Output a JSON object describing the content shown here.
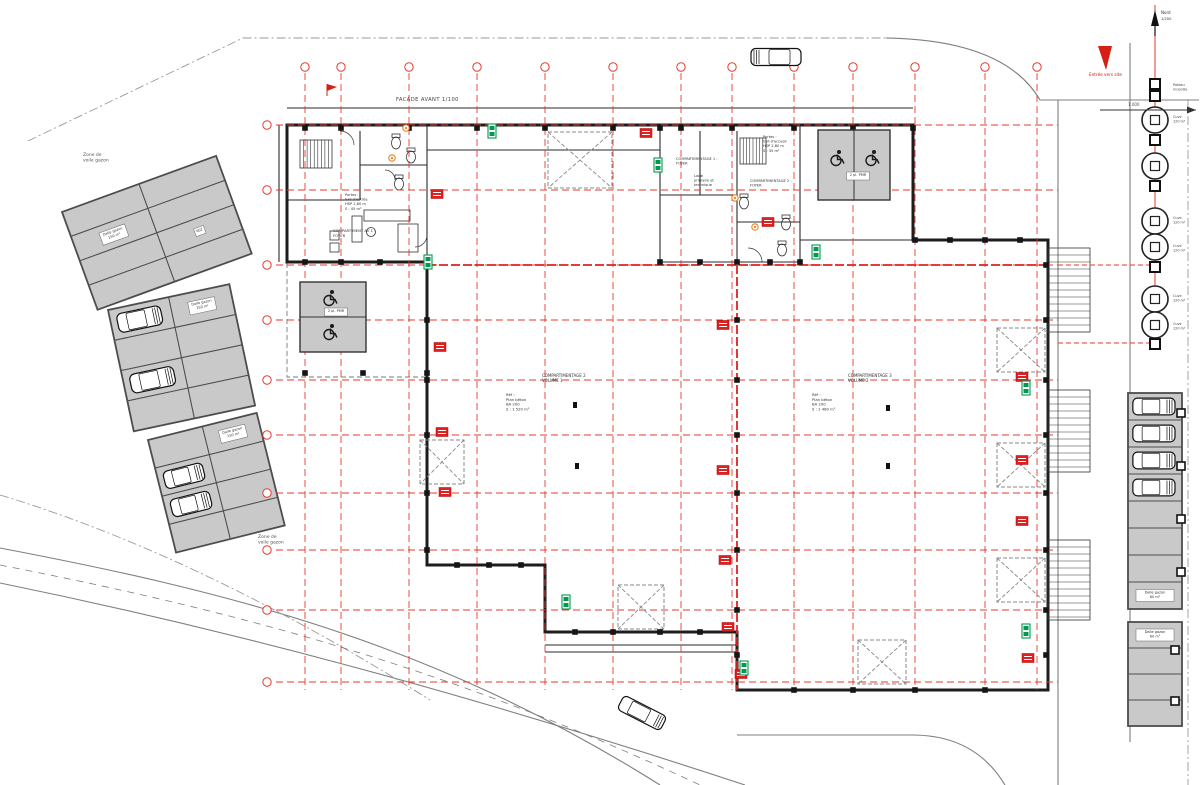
{
  "colors": {
    "grid_red": "#e63a2e",
    "compartment_red": "#e02020",
    "wall": "#1d1d1d",
    "inner_wall": "#2a2a2a",
    "parking_fill": "#c9c9c9",
    "parking_border": "#4d4d4d",
    "road": "#7f7f7f",
    "boundary": "#9a9a9a",
    "exit_green": "#00994d",
    "fire_red": "#e02020",
    "door_orange": "#f5821f",
    "text_gray": "#444444",
    "arrow_red": "#d42015"
  },
  "labels": {
    "facade": "FACADE AVANT 1/100",
    "entrance": "Entrée vers site",
    "north": "Nord",
    "room403": "403"
  },
  "texts": [
    {
      "x": 83,
      "y": 156,
      "size": 4.5,
      "color": "#555555",
      "lines": [
        "Zone de",
        "voile gazon"
      ],
      "name": "zone-label-topleft"
    },
    {
      "x": 258,
      "y": 538,
      "size": 4.5,
      "color": "#555555",
      "lines": [
        "Zone de",
        "voile gazon"
      ],
      "name": "zone-label-bottomleft"
    },
    {
      "x": 542,
      "y": 377,
      "size": 4,
      "color": "#333333",
      "lines": [
        "COMPARTIMENTAGE 2",
        "VOLUME 1"
      ],
      "name": "hall1-title"
    },
    {
      "x": 506,
      "y": 396,
      "size": 3.8,
      "color": "#333333",
      "lines": [
        "Réf :",
        "Plan béton",
        "BA 200",
        "S : 1 520 m²"
      ],
      "name": "hall1-info"
    },
    {
      "x": 848,
      "y": 377,
      "size": 4,
      "color": "#333333",
      "lines": [
        "COMPARTIMENTAGE 3",
        "VOLUME 2"
      ],
      "name": "hall2-title"
    },
    {
      "x": 812,
      "y": 396,
      "size": 3.8,
      "color": "#333333",
      "lines": [
        "Réf :",
        "Plan béton",
        "BA 200",
        "S : 1 480 m²"
      ],
      "name": "hall2-info"
    },
    {
      "x": 333,
      "y": 232,
      "size": 3.8,
      "color": "#333333",
      "lines": [
        "COMPARTIMENT AV 1 :",
        "FOYER"
      ],
      "name": "office1-title"
    },
    {
      "x": 345,
      "y": 196,
      "size": 3.6,
      "color": "#333333",
      "lines": [
        "Portes :",
        "hall d'entrée",
        "HSP 2,80 m",
        "S : 45 m²"
      ],
      "name": "office1-info"
    },
    {
      "x": 763,
      "y": 138,
      "size": 3.6,
      "color": "#333333",
      "lines": [
        "Portes :",
        "hall d'accueil",
        "HSP 2,80 m",
        "S : 35 m²"
      ],
      "name": "office2-info"
    },
    {
      "x": 676,
      "y": 160,
      "size": 3.6,
      "color": "#333333",
      "lines": [
        "COMPARTIMENTAGE 1 :",
        "FOYER"
      ],
      "name": "office2-title"
    },
    {
      "x": 694,
      "y": 177,
      "size": 3.6,
      "color": "#333333",
      "lines": [
        "Local",
        "primaire et",
        "technique"
      ],
      "name": "office2-local"
    },
    {
      "x": 750,
      "y": 182,
      "size": 3.6,
      "color": "#333333",
      "lines": [
        "COMPARTIMENTAGE 2 :",
        "FOYER"
      ],
      "name": "office2-comp"
    },
    {
      "x": 1128,
      "y": 106,
      "size": 4,
      "color": "#555555",
      "lines": [
        "1.000"
      ],
      "name": "dim-label"
    },
    {
      "x": 1161,
      "y": 20,
      "size": 3.6,
      "color": "#333333",
      "lines": [
        "1/200"
      ],
      "name": "north-scale-label"
    }
  ],
  "drawing": {
    "roads": {
      "solid": [
        "M886,38 Q1005,40 1040,100 L1199,100",
        "M1058,100 L1058,785",
        "M1130,43 L1130,742",
        "M0,548 C220,590 430,640 660,785",
        "M0,583 C220,628 450,688 745,785",
        "M737,735 L912,735 Q975,735 1005,785"
      ],
      "dashdot": [
        "M28,141 L243,38 L886,38",
        "M1188,99 L1188,785",
        "M0,495 C150,540 300,618 430,700"
      ],
      "dashed": [
        "M0,565 C220,608 440,663 700,785"
      ]
    },
    "grid": {
      "vx": [
        305,
        341,
        409,
        477,
        545,
        613,
        681,
        732,
        794,
        853,
        915,
        985,
        1037
      ],
      "vy0": 73,
      "vy1": 690,
      "bubble_y": 67,
      "hy": [
        125,
        190,
        265,
        320,
        380,
        435,
        493,
        550,
        610,
        682
      ],
      "hx0": 276,
      "hx1": 1058,
      "bubble_x": 267,
      "extras": [
        [
          1058,
          265,
          1149,
          265
        ],
        [
          1058,
          343,
          1149,
          343
        ]
      ]
    },
    "building": {
      "outline": "M287,125 L913,125 L913,240 L1048,240 L1048,690 L737,690 L737,632 L545,632 L545,565 L427,565 L427,262 L287,262 Z",
      "inner_walls": [
        "M427,125 L427,262",
        "M427,150 L660,150",
        "M360,131 L360,200",
        "M360,165 L427,165",
        "M287,200 L360,200",
        "M660,125 L660,262",
        "M800,125 L800,262",
        "M660,262 L800,262",
        "M660,195 L737,195",
        "M700,131 L700,195",
        "M737,131 L737,262",
        "M737,222 L800,222",
        "M800,240 L913,240",
        "M545,645 L737,645",
        "M545,652 L737,652",
        "M287,108 L913,108",
        "M279,125 L279,262"
      ],
      "stairs": [
        {
          "x": 300,
          "y": 140,
          "w": 32,
          "h": 28,
          "n": 9
        },
        {
          "x": 740,
          "y": 138,
          "w": 26,
          "h": 26,
          "n": 8
        }
      ],
      "toilets": [
        [
          396,
          143
        ],
        [
          411,
          157
        ],
        [
          399,
          184
        ],
        [
          744,
          203
        ],
        [
          786,
          224
        ],
        [
          782,
          250
        ]
      ],
      "desks": [
        [
          352,
          216,
          10,
          26
        ],
        [
          364,
          210,
          46,
          11
        ],
        [
          398,
          224,
          20,
          28
        ],
        [
          330,
          231,
          9,
          9
        ],
        [
          330,
          243,
          9,
          9
        ]
      ],
      "door_arcs": [
        "M340,131 A14,14 0 0 1 354,145",
        "M385,170 A10,10 0 0 1 395,180",
        "M762,262 A14,14 0 0 0 748,248",
        "M427,235 A12,12 0 0 1 415,247"
      ],
      "canopy": {
        "x": 287,
        "y": 262,
        "w": 140,
        "h": 115
      },
      "dock_stairs": [
        [
          248,
          332
        ],
        [
          390,
          472
        ],
        [
          540,
          620
        ]
      ],
      "xboxes": [
        [
          548,
          132,
          64,
          56
        ],
        [
          420,
          440,
          44,
          44
        ],
        [
          618,
          585,
          46,
          44
        ],
        [
          858,
          640,
          48,
          44
        ],
        [
          997,
          328,
          48,
          44
        ],
        [
          997,
          443,
          48,
          44
        ],
        [
          997,
          558,
          48,
          44
        ]
      ],
      "compartment_lines": [
        "M737,265 L737,690",
        "M427,265 L1048,265"
      ],
      "door_symbols": [
        [
          575,
          405
        ],
        [
          577,
          466
        ],
        [
          888,
          408
        ],
        [
          888,
          466
        ]
      ]
    },
    "columns": {
      "rows": [
        {
          "axis": "y",
          "v": 128,
          "pts": [
            305,
            341,
            409,
            477,
            545,
            613,
            660,
            681,
            732,
            794,
            853,
            913
          ]
        },
        {
          "axis": "x",
          "v": 427,
          "pts": [
            265,
            320,
            380,
            435,
            493,
            550
          ]
        },
        {
          "axis": "x",
          "v": 737,
          "pts": [
            320,
            380,
            435,
            493,
            550,
            610,
            655
          ]
        },
        {
          "axis": "x",
          "v": 1046,
          "pts": [
            265,
            320,
            380,
            435,
            493,
            550,
            610,
            655
          ]
        },
        {
          "axis": "y",
          "v": 690,
          "pts": [
            794,
            853,
            915,
            985
          ]
        },
        {
          "axis": "y",
          "v": 632,
          "pts": [
            575,
            613,
            660,
            700
          ]
        },
        {
          "axis": "y",
          "v": 565,
          "pts": [
            457,
            489,
            521
          ]
        },
        {
          "axis": "y",
          "v": 262,
          "pts": [
            305,
            341,
            380,
            427,
            660,
            700,
            737,
            770,
            800
          ]
        },
        {
          "axis": "y",
          "v": 240,
          "pts": [
            915,
            950,
            985,
            1020
          ]
        },
        {
          "axis": "y",
          "v": 373,
          "pts": [
            305,
            363,
            427
          ]
        }
      ]
    },
    "parking": {
      "blocks": [
        {
          "x": 62,
          "y": 212,
          "rot": -20,
          "cols": 2,
          "rows": 4,
          "cw": 82,
          "rh": 26,
          "cars": [],
          "chips": [
            {
              "c": 0,
              "r": 1,
              "lines": [
                "Dalle gazon",
                "150 m²"
              ]
            },
            {
              "c": 1,
              "r": 2,
              "lines": [
                "602"
              ]
            }
          ]
        },
        {
          "x": 108,
          "y": 310,
          "rot": -12,
          "cols": 2,
          "rows": 4,
          "cw": 62,
          "rh": 31,
          "cars": [
            {
              "c": 0,
              "r": 0
            },
            {
              "c": 0,
              "r": 2
            }
          ],
          "chips": [
            {
              "c": 1,
              "r": 0,
              "lines": [
                "Dalle gazon",
                "150 m²"
              ]
            }
          ]
        },
        {
          "x": 148,
          "y": 440,
          "rot": -14,
          "cols": 2,
          "rows": 4,
          "cw": 56,
          "rh": 29,
          "cars": [
            {
              "c": 0,
              "r": 1
            },
            {
              "c": 0,
              "r": 2
            }
          ],
          "chips": [
            {
              "c": 1,
              "r": 0,
              "lines": [
                "Dalle gazon",
                "150 m²"
              ]
            }
          ]
        }
      ],
      "strips": [
        {
          "x": 1128,
          "y": 393,
          "w": 54,
          "rows": 8,
          "rh": 27,
          "cars": [
            0,
            1,
            2,
            3
          ],
          "chipRow": 7,
          "chipLines": [
            "Dalle gazon",
            "60 m²"
          ]
        },
        {
          "x": 1128,
          "y": 622,
          "w": 54,
          "rows": 4,
          "rh": 26,
          "cars": [],
          "chipRow": 0,
          "chipLines": [
            "Dalle gazon",
            "60 m²"
          ]
        }
      ],
      "nodes": [
        [
          1181,
          413
        ],
        [
          1181,
          466
        ],
        [
          1181,
          519
        ],
        [
          1181,
          572
        ],
        [
          1175,
          650
        ],
        [
          1175,
          701
        ]
      ]
    },
    "pmr": [
      {
        "x": 300,
        "y": 282,
        "w": 66,
        "h": 70,
        "divider": "h",
        "chip": {
          "x": 336,
          "y": 312,
          "lines": [
            "2 pl. PMR"
          ]
        },
        "wc": [
          [
            330,
            298
          ],
          [
            330,
            332
          ]
        ]
      },
      {
        "x": 818,
        "y": 130,
        "w": 72,
        "h": 70,
        "divider": "v",
        "chip": {
          "x": 858,
          "y": 176,
          "lines": [
            "2 pl. PMR"
          ]
        },
        "wc": [
          [
            837,
            158
          ],
          [
            872,
            158
          ]
        ]
      }
    ],
    "tanks": {
      "x": 1155,
      "r": 13,
      "circles": [
        120,
        166,
        221,
        247,
        299,
        325
      ],
      "squares": [
        84,
        96,
        140,
        186,
        267,
        344
      ],
      "labels": [
        {
          "y": 86,
          "lines": [
            "Poteau",
            "incendie"
          ]
        },
        {
          "y": 118,
          "lines": [
            "Cuve",
            "120 m³"
          ]
        },
        {
          "y": 219,
          "lines": [
            "Cuve",
            "120 m³"
          ]
        },
        {
          "y": 247,
          "lines": [
            "Cuve",
            "120 m³"
          ]
        },
        {
          "y": 297,
          "lines": [
            "Cuve",
            "120 m³"
          ]
        },
        {
          "y": 325,
          "lines": [
            "Cuve",
            "120 m³"
          ]
        }
      ],
      "redline": [
        5,
        345
      ]
    },
    "chips": {
      "fire": [
        [
          437,
          194
        ],
        [
          646,
          133
        ],
        [
          768,
          222
        ],
        [
          440,
          347
        ],
        [
          442,
          432
        ],
        [
          445,
          492
        ],
        [
          723,
          325
        ],
        [
          723,
          470
        ],
        [
          725,
          560
        ],
        [
          728,
          627
        ],
        [
          1022,
          377
        ],
        [
          1022,
          460
        ],
        [
          1022,
          521
        ],
        [
          1028,
          658
        ],
        [
          741,
          674
        ]
      ],
      "exit": [
        [
          492,
          131
        ],
        [
          816,
          252
        ],
        [
          566,
          602
        ],
        [
          744,
          668
        ],
        [
          1026,
          388
        ],
        [
          1026,
          631
        ],
        [
          428,
          262
        ],
        [
          658,
          165
        ]
      ],
      "orange": [
        [
          406,
          128
        ],
        [
          392,
          158
        ],
        [
          735,
          198
        ],
        [
          755,
          227
        ]
      ]
    },
    "cars_free": [
      {
        "x": 776,
        "y": 57,
        "ang": 180,
        "l": 50,
        "w": 17
      },
      {
        "x": 642,
        "y": 713,
        "ang": 27,
        "l": 48,
        "w": 16
      }
    ],
    "flag": {
      "x": 327,
      "y": 84
    },
    "north_arrow": {
      "x": 1155,
      "y": 10
    },
    "entrance_arrow": {
      "pts": "1098,46 1112,46 1106,70"
    },
    "dim_arrow": {
      "x1": 1100,
      "y1": 110,
      "x2": 1196,
      "y2": 110
    }
  }
}
